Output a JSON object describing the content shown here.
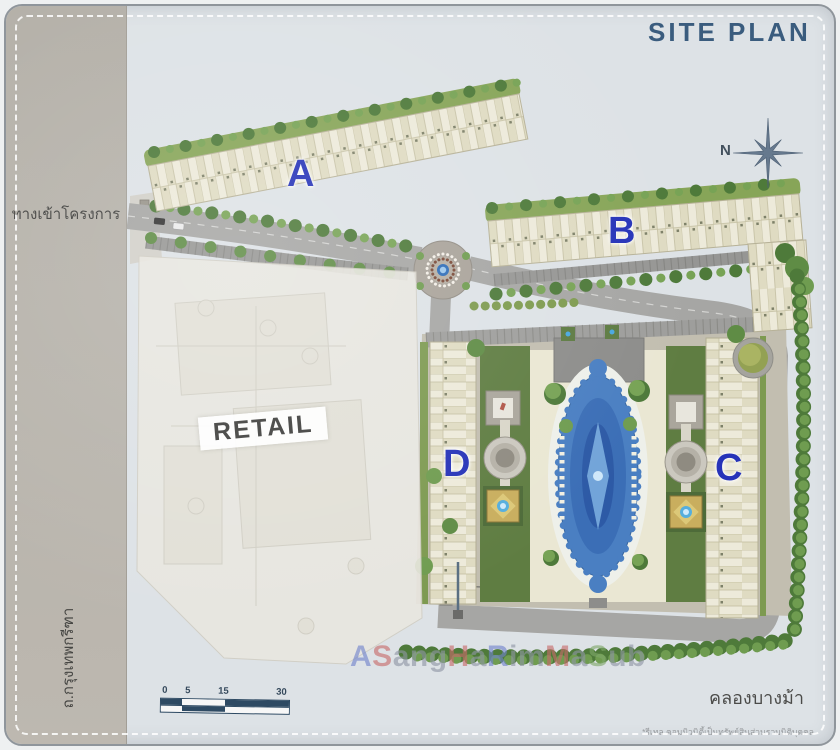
{
  "header": {
    "title": "SITE PLAN"
  },
  "compass": {
    "n": "N"
  },
  "building_labels": {
    "a": "A",
    "b": "B",
    "c": "C",
    "d": "D"
  },
  "areas": {
    "retail": "RETAIL"
  },
  "roads": {
    "entrance": "ทางเข้าโครงการ",
    "west_road": "ถ.กรุงเทพกรีฑา",
    "canal": "คลองบางม้า"
  },
  "footnote": {
    "disclaimer": "*รีเทล คอมมิวนิตี้เป็นทรัพย์สินส่วนรวมนิติบุคคล"
  },
  "scale_bar": {
    "ticks": [
      "0",
      "5",
      "15",
      "30"
    ]
  },
  "watermark": {
    "text": "ASangHaRimMaSub",
    "segments": [
      {
        "t": "A",
        "c": "#7083cc"
      },
      {
        "t": "S",
        "c": "#c76a6a"
      },
      {
        "t": "ang",
        "c": "#8f96a4"
      },
      {
        "t": "H",
        "c": "#c76a6a"
      },
      {
        "t": "a",
        "c": "#8f96a4"
      },
      {
        "t": "R",
        "c": "#7083cc"
      },
      {
        "t": "im",
        "c": "#8f96a4"
      },
      {
        "t": "M",
        "c": "#c76a6a"
      },
      {
        "t": "a",
        "c": "#8f96a4"
      },
      {
        "t": "S",
        "c": "#7fa86a"
      },
      {
        "t": "ub",
        "c": "#8f96a4"
      }
    ]
  },
  "colors": {
    "building_letter": "#2633b8",
    "title_text": "#3a5c7e",
    "pool_blue": "#4a7fc2",
    "landscape_green": "#6f9c50",
    "road_gray": "#a6a6a4"
  }
}
